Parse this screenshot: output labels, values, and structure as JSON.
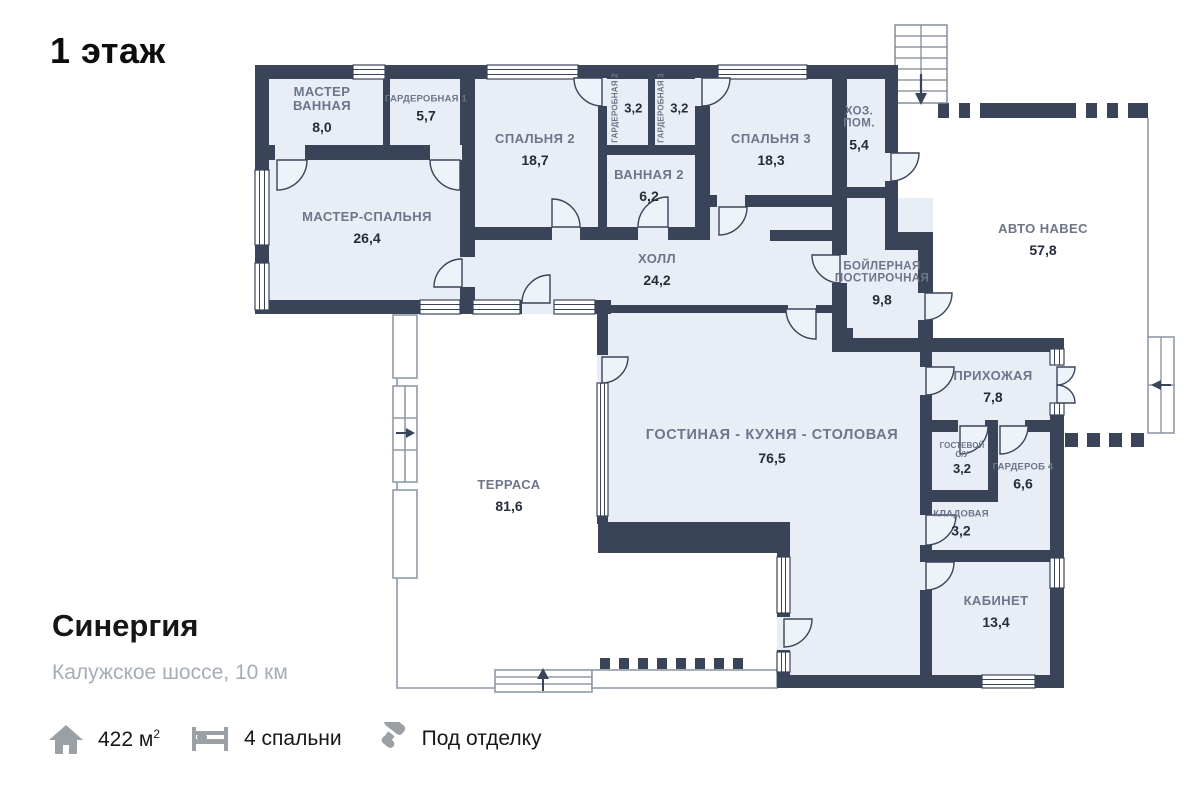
{
  "floor_label": "1 этаж",
  "project": {
    "name": "Синергия",
    "location": "Калужское шоссе, 10 км"
  },
  "stats": {
    "area_value": "422 м",
    "area_sup": "2",
    "bedrooms": "4 спальни",
    "finish": "Под отделку"
  },
  "colors": {
    "wall": "#3a4458",
    "room_fill": "#e9edf6",
    "label_gray": "#6d7689",
    "number_dark": "#262c3a",
    "outline_gray": "#9099a6"
  },
  "rooms": [
    {
      "id": "master-bathroom",
      "name": "МАСТЕР\nВАННАЯ",
      "area": "8,0"
    },
    {
      "id": "wardrobe-1",
      "name": "ГАРДЕРОБНАЯ 1",
      "area": "5,7"
    },
    {
      "id": "bedroom-2",
      "name": "СПАЛЬНЯ 2",
      "area": "18,7"
    },
    {
      "id": "wardrobe-2",
      "name": "ГАРДЕРОБНАЯ 2",
      "area": "3,2"
    },
    {
      "id": "wardrobe-3",
      "name": "ГАРДЕРОБНАЯ 3",
      "area": "3,2"
    },
    {
      "id": "bedroom-3",
      "name": "СПАЛЬНЯ 3",
      "area": "18,3"
    },
    {
      "id": "utility-room",
      "name": "ХОЗ.\nПОМ.",
      "area": "5,4"
    },
    {
      "id": "master-bedroom",
      "name": "МАСТЕР-СПАЛЬНЯ",
      "area": "26,4"
    },
    {
      "id": "bathroom-2",
      "name": "ВАННАЯ 2",
      "area": "6,2"
    },
    {
      "id": "hall",
      "name": "ХОЛЛ",
      "area": "24,2"
    },
    {
      "id": "boiler-laundry",
      "name": "БОЙЛЕРНАЯ\nПОСТИРОЧНАЯ",
      "area": "9,8"
    },
    {
      "id": "carport",
      "name": "АВТО НАВЕС",
      "area": "57,8"
    },
    {
      "id": "entry-hall",
      "name": "ПРИХОЖАЯ",
      "area": "7,8"
    },
    {
      "id": "guest-wc",
      "name": "ГОСТЕВОЙ\nС/У",
      "area": "3,2"
    },
    {
      "id": "wardrobe-4",
      "name": "ГАРДЕРОБ 4",
      "area": "6,6"
    },
    {
      "id": "storage",
      "name": "КЛАДОВАЯ",
      "area": "3,2"
    },
    {
      "id": "living-kitchen-dining",
      "name": "ГОСТИНАЯ - КУХНЯ - СТОЛОВАЯ",
      "area": "76,5"
    },
    {
      "id": "terrace",
      "name": "ТЕРРАСА",
      "area": "81,6"
    },
    {
      "id": "study",
      "name": "КАБИНЕТ",
      "area": "13,4"
    }
  ]
}
